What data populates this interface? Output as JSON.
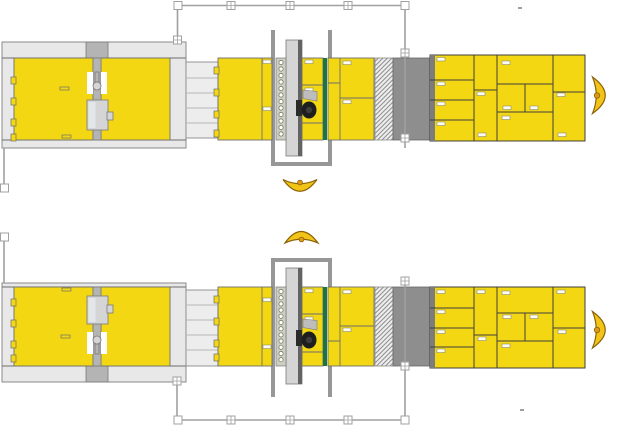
{
  "diagram": {
    "type": "floor-plan of two parallel panel processing lines",
    "lines": [
      {
        "name": "production-line-1",
        "position": "top",
        "flow": [
          "feeding-press",
          "roller-conveyor",
          "panel-buffer",
          "drilling-gantry-station",
          "green-marker-strip",
          "outfeed-panels",
          "coil-section",
          "transfer-block",
          "nested-panel-stack",
          "turning-device"
        ]
      },
      {
        "name": "production-line-2",
        "position": "bottom",
        "flow": [
          "feeding-press",
          "roller-conveyor",
          "panel-buffer",
          "drilling-gantry-station",
          "green-marker-strip",
          "outfeed-panels",
          "coil-section",
          "transfer-block",
          "nested-panel-stack",
          "turning-device"
        ]
      }
    ],
    "rail_connector_count_per_rail": 3,
    "drill_hole_count": 12
  },
  "colors": {
    "panel_yellow": "#F2D712",
    "panel_border": "#6E6E6E",
    "frame_light": "#E8E8E8",
    "frame_border": "#8A8A8A",
    "machine_gray": "#B4B4B4",
    "machine_border": "#7A7A7A",
    "beam_gray": "#D5D5D5",
    "beam_dark": "#636363",
    "mech_inner": "#E3E7EA",
    "block_gray": "#8E8E8E",
    "block_border": "#666666",
    "grid_edge": "#7C7C7C",
    "grid_line": "#3F3F3F",
    "green": "#1B7441",
    "u_frame": "#979797",
    "rail": "#A0A0A0",
    "tick": "#FCFCF0",
    "crescent": "#F2C418",
    "crescent_outline": "#8A6208",
    "crescent_hub": "#E09A12",
    "hole_ring": "#6E6E52",
    "strip": "#CBCEC0",
    "dark": "#2A2A2A",
    "motor": "#1E1E1E",
    "flag": "#BDBDBD",
    "conveyor": "#EDEDED",
    "conv_line": "#B8B8B8",
    "hatch": "#8F8F8F"
  }
}
